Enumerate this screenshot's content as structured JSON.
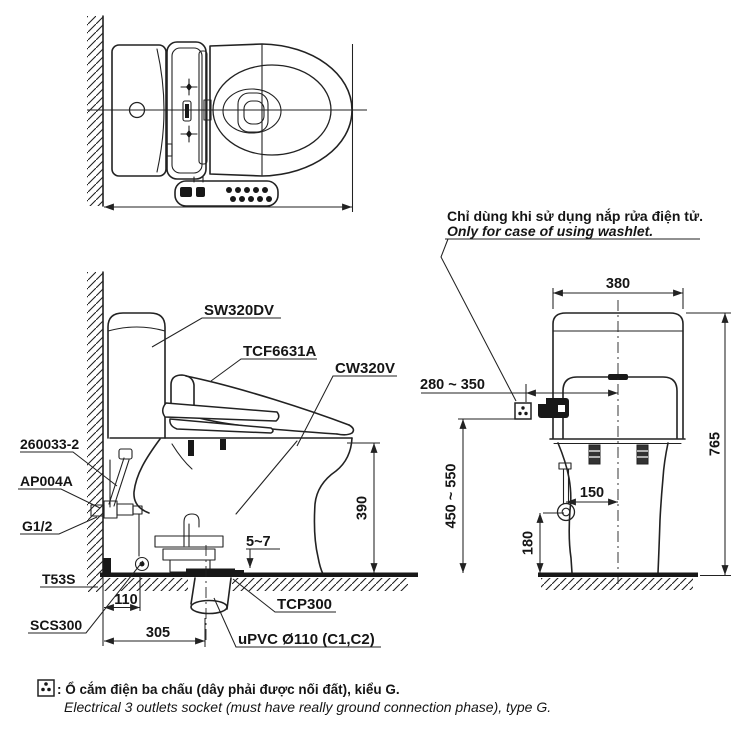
{
  "note": {
    "vi": "Chỉ dùng khi sử dụng nắp rửa điện tử.",
    "en": "Only for case of using washlet."
  },
  "legend": {
    "vi": ": Ổ cắm điện ba chấu (dây phải được nối đất), kiểu G.",
    "en": "Electrical 3 outlets socket (must have really ground connection phase), type G.",
    "icon": "three-pin-socket"
  },
  "labels": {
    "tank": "SW320DV",
    "washlet_seat": "TCF6631A",
    "bowl": "CW320V",
    "tank_connector": "260033-2",
    "angle_valve": "AP004A",
    "water_thread": "G1/2",
    "stop_valve": "T53S",
    "supply_hose": "SCS300",
    "floor_flange": "TCP300",
    "drain_pipe": "uPVC Ø110 (C1,C2)"
  },
  "dimensions": {
    "tank_width": "380",
    "socket_offset": "280 ~ 350",
    "total_height": "765",
    "socket_height": "450 ~ 550",
    "supply_offset": "150",
    "supply_height": "180",
    "rim_height": "390",
    "base_gap": "5~7",
    "valve_from_wall": "110",
    "drain_from_wall": "305"
  },
  "icons": {
    "power_socket": "three-pin-socket"
  },
  "colors": {
    "ink": "#222222",
    "paper": "#ffffff"
  }
}
